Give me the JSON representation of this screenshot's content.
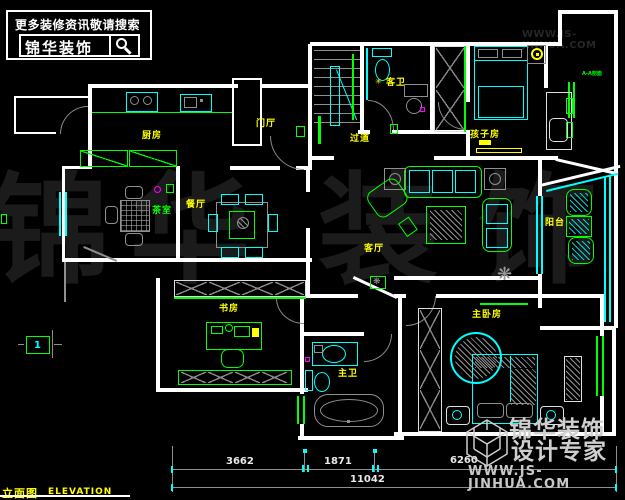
{
  "header": {
    "tagline": "更多装修资讯敬请搜索",
    "brand": "锦华装饰"
  },
  "site_watermark_top": "WWW.JS-JINHUA.COM",
  "rooms": {
    "kitchen": "厨房",
    "foyer": "门厅",
    "hallway": "过道",
    "guest_bath": "客卫",
    "kids_room": "孩子房",
    "tea_room": "茶室",
    "dining": "餐厅",
    "living": "客厅",
    "balcony": "阳台",
    "study": "书房",
    "master_bath": "主卫",
    "master_bedroom": "主卧房"
  },
  "annotations": {
    "section_label": "A-A剖面",
    "detail_marker": "1",
    "bath_star": "✳",
    "plant_glyph": "❋"
  },
  "dims": {
    "d1": "3662",
    "d2": "1871",
    "d3": "6260",
    "total": "11042"
  },
  "title_block": {
    "cn": "立面图",
    "en": "ELEVATION"
  },
  "brand_watermark": {
    "line1": "锦华装饰",
    "line2": "设计专家",
    "site": "WWW.JS-JINHUA.COM"
  },
  "watermark_chars": [
    "锦",
    "华",
    "装",
    "饰"
  ],
  "colors": {
    "wall": "#ffffff",
    "green": "#00ff00",
    "cyan": "#00ffff",
    "yellow": "#ffff00",
    "gray": "#9c9c9c",
    "magenta": "#ff00ff",
    "background": "#000000"
  }
}
